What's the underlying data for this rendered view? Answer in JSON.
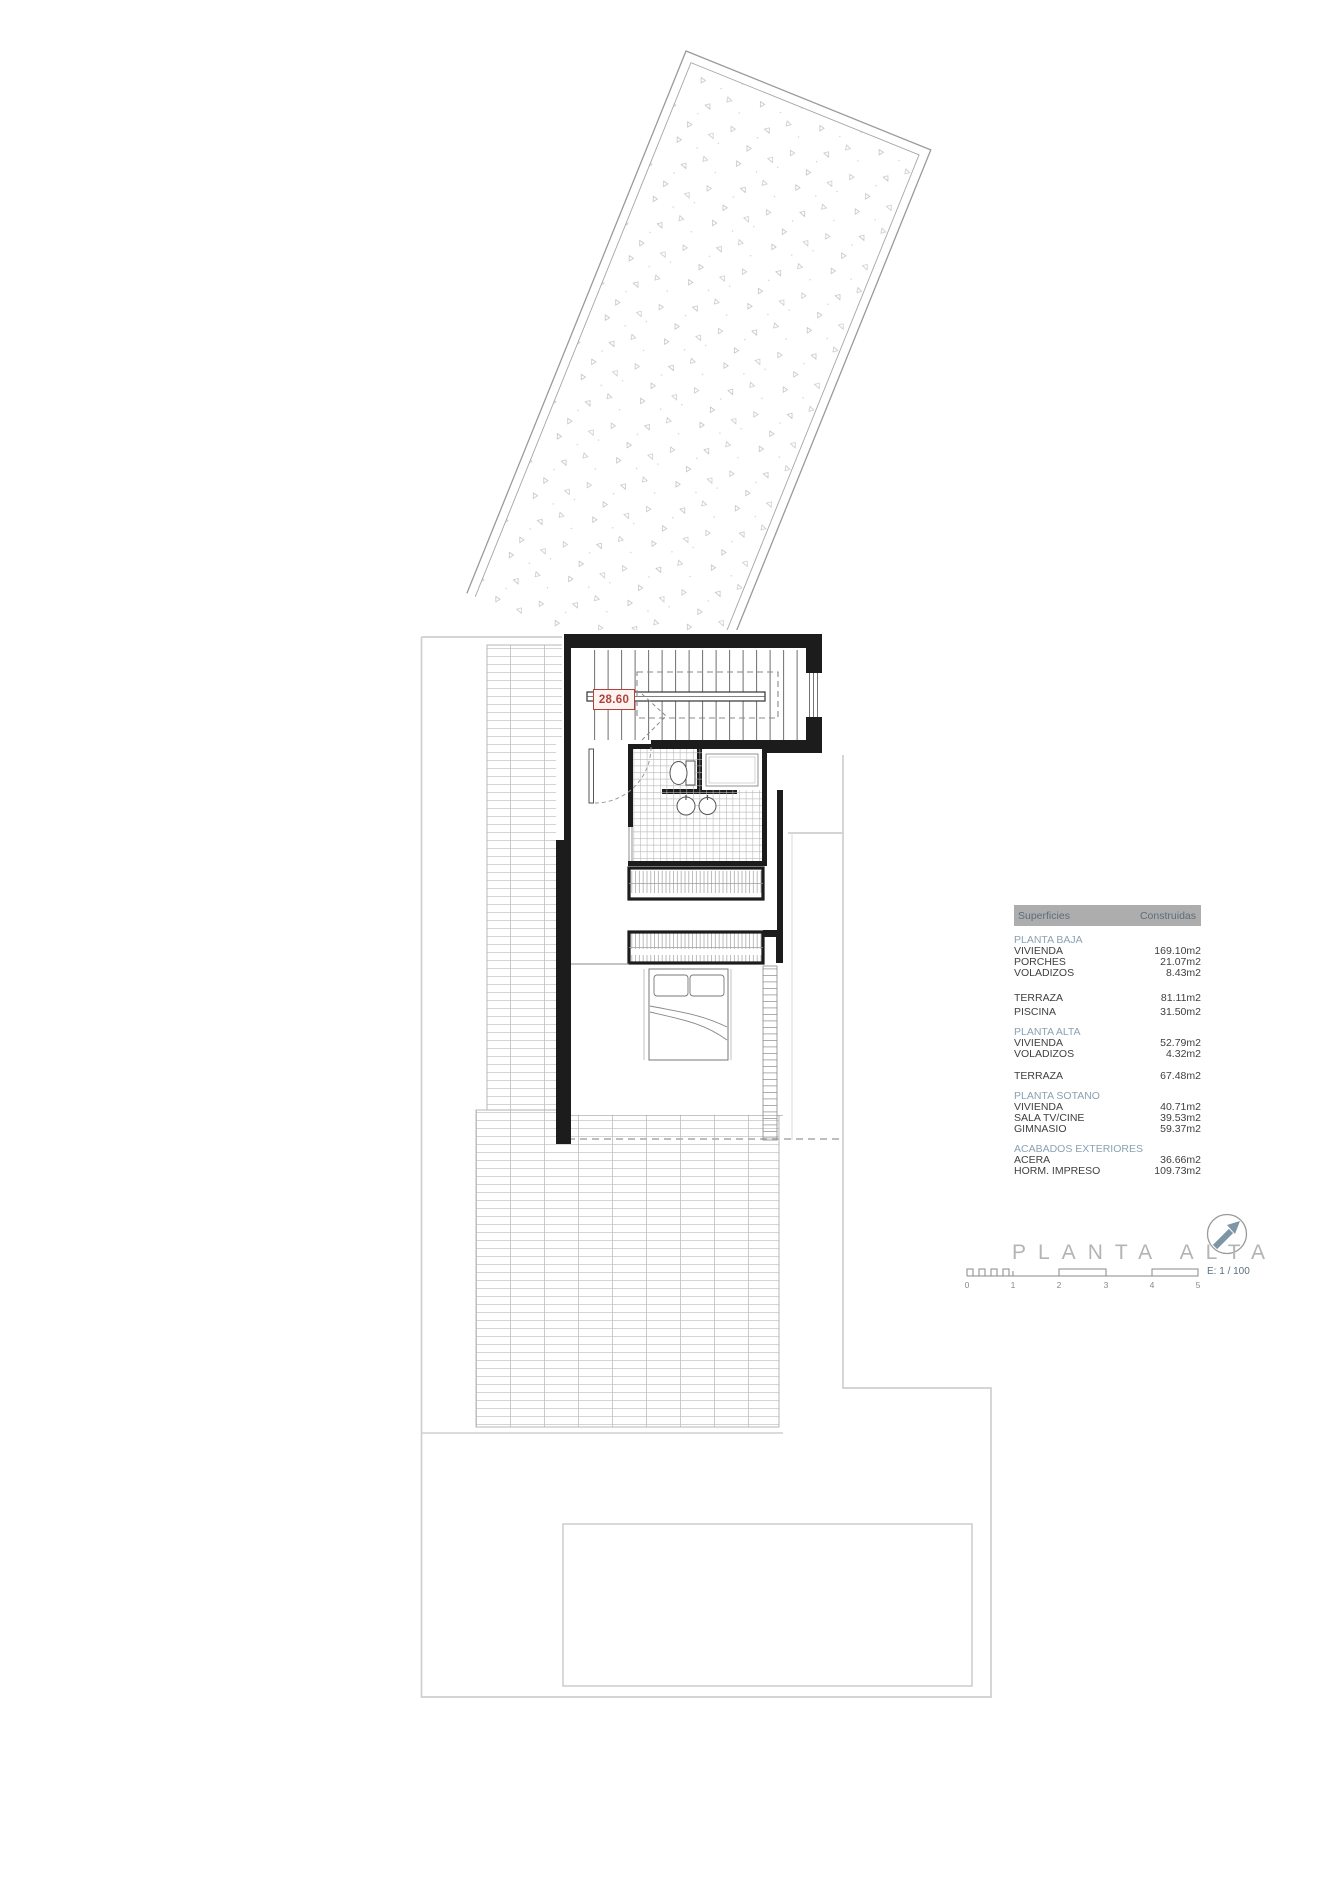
{
  "drawing": {
    "level_label": "28.60",
    "title": "PLANTA ALTA",
    "scale_text": "E: 1 / 100",
    "scale_ticks": [
      "0",
      "1",
      "2",
      "3",
      "4",
      "5"
    ]
  },
  "colors": {
    "level_accent": "#b0423a",
    "section_blue": "#8ba2b3",
    "header_gray": "#adadad",
    "north_arrow_blue": "#7e95a6"
  },
  "surfaces_table": {
    "header": {
      "col1": "Superficies",
      "col2": "Construidas"
    },
    "rows": [
      {
        "kind": "section",
        "label": "PLANTA BAJA",
        "value": ""
      },
      {
        "kind": "item",
        "label": "VIVIENDA",
        "value": "169.10m2"
      },
      {
        "kind": "item",
        "label": "PORCHES",
        "value": "21.07m2"
      },
      {
        "kind": "item",
        "label": "VOLADIZOS",
        "value": "8.43m2"
      },
      {
        "kind": "item",
        "label": "TERRAZA",
        "value": "81.11m2"
      },
      {
        "kind": "item",
        "label": "PISCINA",
        "value": "31.50m2"
      },
      {
        "kind": "section",
        "label": "PLANTA ALTA",
        "value": ""
      },
      {
        "kind": "item",
        "label": "VIVIENDA",
        "value": "52.79m2"
      },
      {
        "kind": "item",
        "label": "VOLADIZOS",
        "value": "4.32m2"
      },
      {
        "kind": "item",
        "label": "TERRAZA",
        "value": "67.48m2"
      },
      {
        "kind": "section",
        "label": "PLANTA SOTANO",
        "value": ""
      },
      {
        "kind": "item",
        "label": "VIVIENDA",
        "value": "40.71m2"
      },
      {
        "kind": "item",
        "label": "SALA TV/CINE",
        "value": "39.53m2"
      },
      {
        "kind": "item",
        "label": "GIMNASIO",
        "value": "59.37m2"
      },
      {
        "kind": "section",
        "label": "ACABADOS EXTERIORES",
        "value": ""
      },
      {
        "kind": "item",
        "label": "ACERA",
        "value": "36.66m2"
      },
      {
        "kind": "item",
        "label": "HORM. IMPRESO",
        "value": "109.73m2"
      }
    ]
  }
}
